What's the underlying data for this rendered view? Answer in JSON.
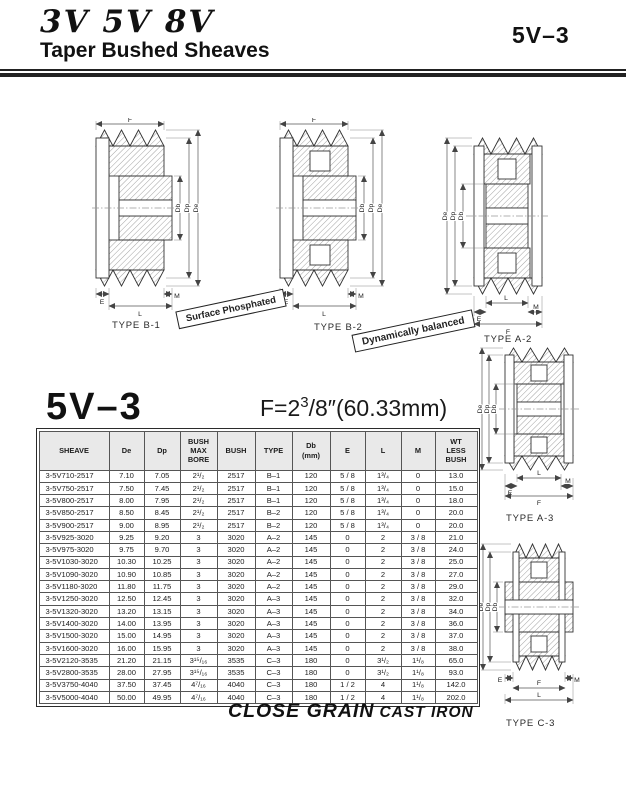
{
  "header": {
    "series_title": "3V 5V 8V",
    "subtitle": "Taper Bushed Sheaves",
    "page_code": "5V–3"
  },
  "drawings": {
    "dim_labels": {
      "f": "F",
      "de": "De",
      "dp": "Dp",
      "db": "Db",
      "e": "E",
      "l": "L",
      "m": "M"
    },
    "type_labels": {
      "b1": "TYPE B-1",
      "b2": "TYPE B-2",
      "a2": "TYPE  A-2",
      "a3": "TYPE A-3",
      "c3": "TYPE C-3"
    },
    "banners": {
      "surface": "Surface  Phosphated",
      "balanced": "Dynamically balanced"
    }
  },
  "section": {
    "model": "5V–3",
    "formula": {
      "prefix": "F=2",
      "sup": "3",
      "rest": "/8″(60.33mm)"
    }
  },
  "table": {
    "headers": [
      "SHEAVE",
      "De",
      "Dp",
      "BUSH\nMAX\nBORE",
      "BUSH",
      "TYPE",
      "Db\n(mm)",
      "E",
      "L",
      "M",
      "WT\nLESS\nBUSH"
    ],
    "rows": [
      [
        "3-5V710-2517",
        "7.10",
        "7.05",
        "2¹/₂",
        "2517",
        "B–1",
        "120",
        "5 / 8",
        "1³/₄",
        "0",
        "13.0"
      ],
      [
        "3-5V750-2517",
        "7.50",
        "7.45",
        "2¹/₂",
        "2517",
        "B–1",
        "120",
        "5 / 8",
        "1³/₄",
        "0",
        "15.0"
      ],
      [
        "3-5V800-2517",
        "8.00",
        "7.95",
        "2¹/₂",
        "2517",
        "B–1",
        "120",
        "5 / 8",
        "1³/₄",
        "0",
        "18.0"
      ],
      [
        "3-5V850-2517",
        "8.50",
        "8.45",
        "2¹/₂",
        "2517",
        "B–2",
        "120",
        "5 / 8",
        "1³/₄",
        "0",
        "20.0"
      ],
      [
        "3-5V900-2517",
        "9.00",
        "8.95",
        "2¹/₂",
        "2517",
        "B–2",
        "120",
        "5 / 8",
        "1³/₄",
        "0",
        "20.0"
      ],
      [
        "3-5V925-3020",
        "9.25",
        "9.20",
        "3",
        "3020",
        "A–2",
        "145",
        "0",
        "2",
        "3 / 8",
        "21.0"
      ],
      [
        "3-5V975-3020",
        "9.75",
        "9.70",
        "3",
        "3020",
        "A–2",
        "145",
        "0",
        "2",
        "3 / 8",
        "24.0"
      ],
      [
        "3-5V1030-3020",
        "10.30",
        "10.25",
        "3",
        "3020",
        "A–2",
        "145",
        "0",
        "2",
        "3 / 8",
        "25.0"
      ],
      [
        "3-5V1090-3020",
        "10.90",
        "10.85",
        "3",
        "3020",
        "A–2",
        "145",
        "0",
        "2",
        "3 / 8",
        "27.0"
      ],
      [
        "3-5V1180-3020",
        "11.80",
        "11.75",
        "3",
        "3020",
        "A–2",
        "145",
        "0",
        "2",
        "3 / 8",
        "29.0"
      ],
      [
        "3-5V1250-3020",
        "12.50",
        "12.45",
        "3",
        "3020",
        "A–3",
        "145",
        "0",
        "2",
        "3 / 8",
        "32.0"
      ],
      [
        "3-5V1320-3020",
        "13.20",
        "13.15",
        "3",
        "3020",
        "A–3",
        "145",
        "0",
        "2",
        "3 / 8",
        "34.0"
      ],
      [
        "3-5V1400-3020",
        "14.00",
        "13.95",
        "3",
        "3020",
        "A–3",
        "145",
        "0",
        "2",
        "3 / 8",
        "36.0"
      ],
      [
        "3-5V1500-3020",
        "15.00",
        "14.95",
        "3",
        "3020",
        "A–3",
        "145",
        "0",
        "2",
        "3 / 8",
        "37.0"
      ],
      [
        "3-5V1600-3020",
        "16.00",
        "15.95",
        "3",
        "3020",
        "A–3",
        "145",
        "0",
        "2",
        "3 / 8",
        "38.0"
      ],
      [
        "3-5V2120-3535",
        "21.20",
        "21.15",
        "3¹⁵/₁₆",
        "3535",
        "C–3",
        "180",
        "0",
        "3¹/₂",
        "1¹/₈",
        "65.0"
      ],
      [
        "3-5V2800-3535",
        "28.00",
        "27.95",
        "3¹⁵/₁₆",
        "3535",
        "C–3",
        "180",
        "0",
        "3¹/₂",
        "1¹/₈",
        "93.0"
      ],
      [
        "3-5V3750-4040",
        "37.50",
        "37.45",
        "4⁷/₁₆",
        "4040",
        "C–3",
        "180",
        "1 / 2",
        "4",
        "1¹/₈",
        "142.0"
      ],
      [
        "3-5V5000-4040",
        "50.00",
        "49.95",
        "4⁷/₁₆",
        "4040",
        "C–3",
        "180",
        "1 / 2",
        "4",
        "1¹/₈",
        "202.0"
      ]
    ]
  },
  "footer": {
    "bold": "CLOSE GRAIN",
    "light": "CAST IRON"
  }
}
